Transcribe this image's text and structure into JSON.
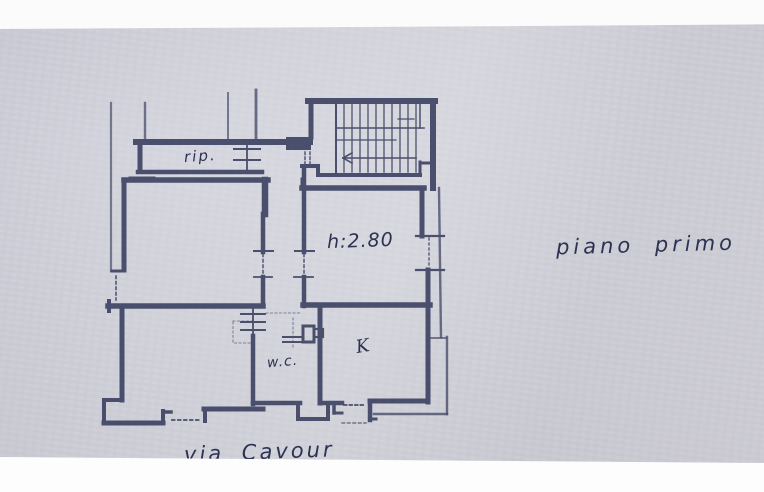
{
  "photo": {
    "description": "Photograph of a hand-drafted cadastral floor plan on paper",
    "paper_color": "#d5d5de",
    "ink_color": "#3a4060",
    "margin_color": "#fbfbfc"
  },
  "labels": {
    "storage_room": "rip.",
    "ceiling_height": "h:2.80",
    "wc_room": "w.c.",
    "kitchen_room": "K",
    "floor_note": "piano primo",
    "street_note": "via Cavour"
  },
  "plan_features": {
    "stairwell": "hatched stair flight with left-pointing direction arrow",
    "rooms_labeled": [
      "rip.",
      "w.c.",
      "K"
    ],
    "door_openings": "dashed gaps in hallway walls",
    "windows": "tick-marked wall symbols"
  }
}
